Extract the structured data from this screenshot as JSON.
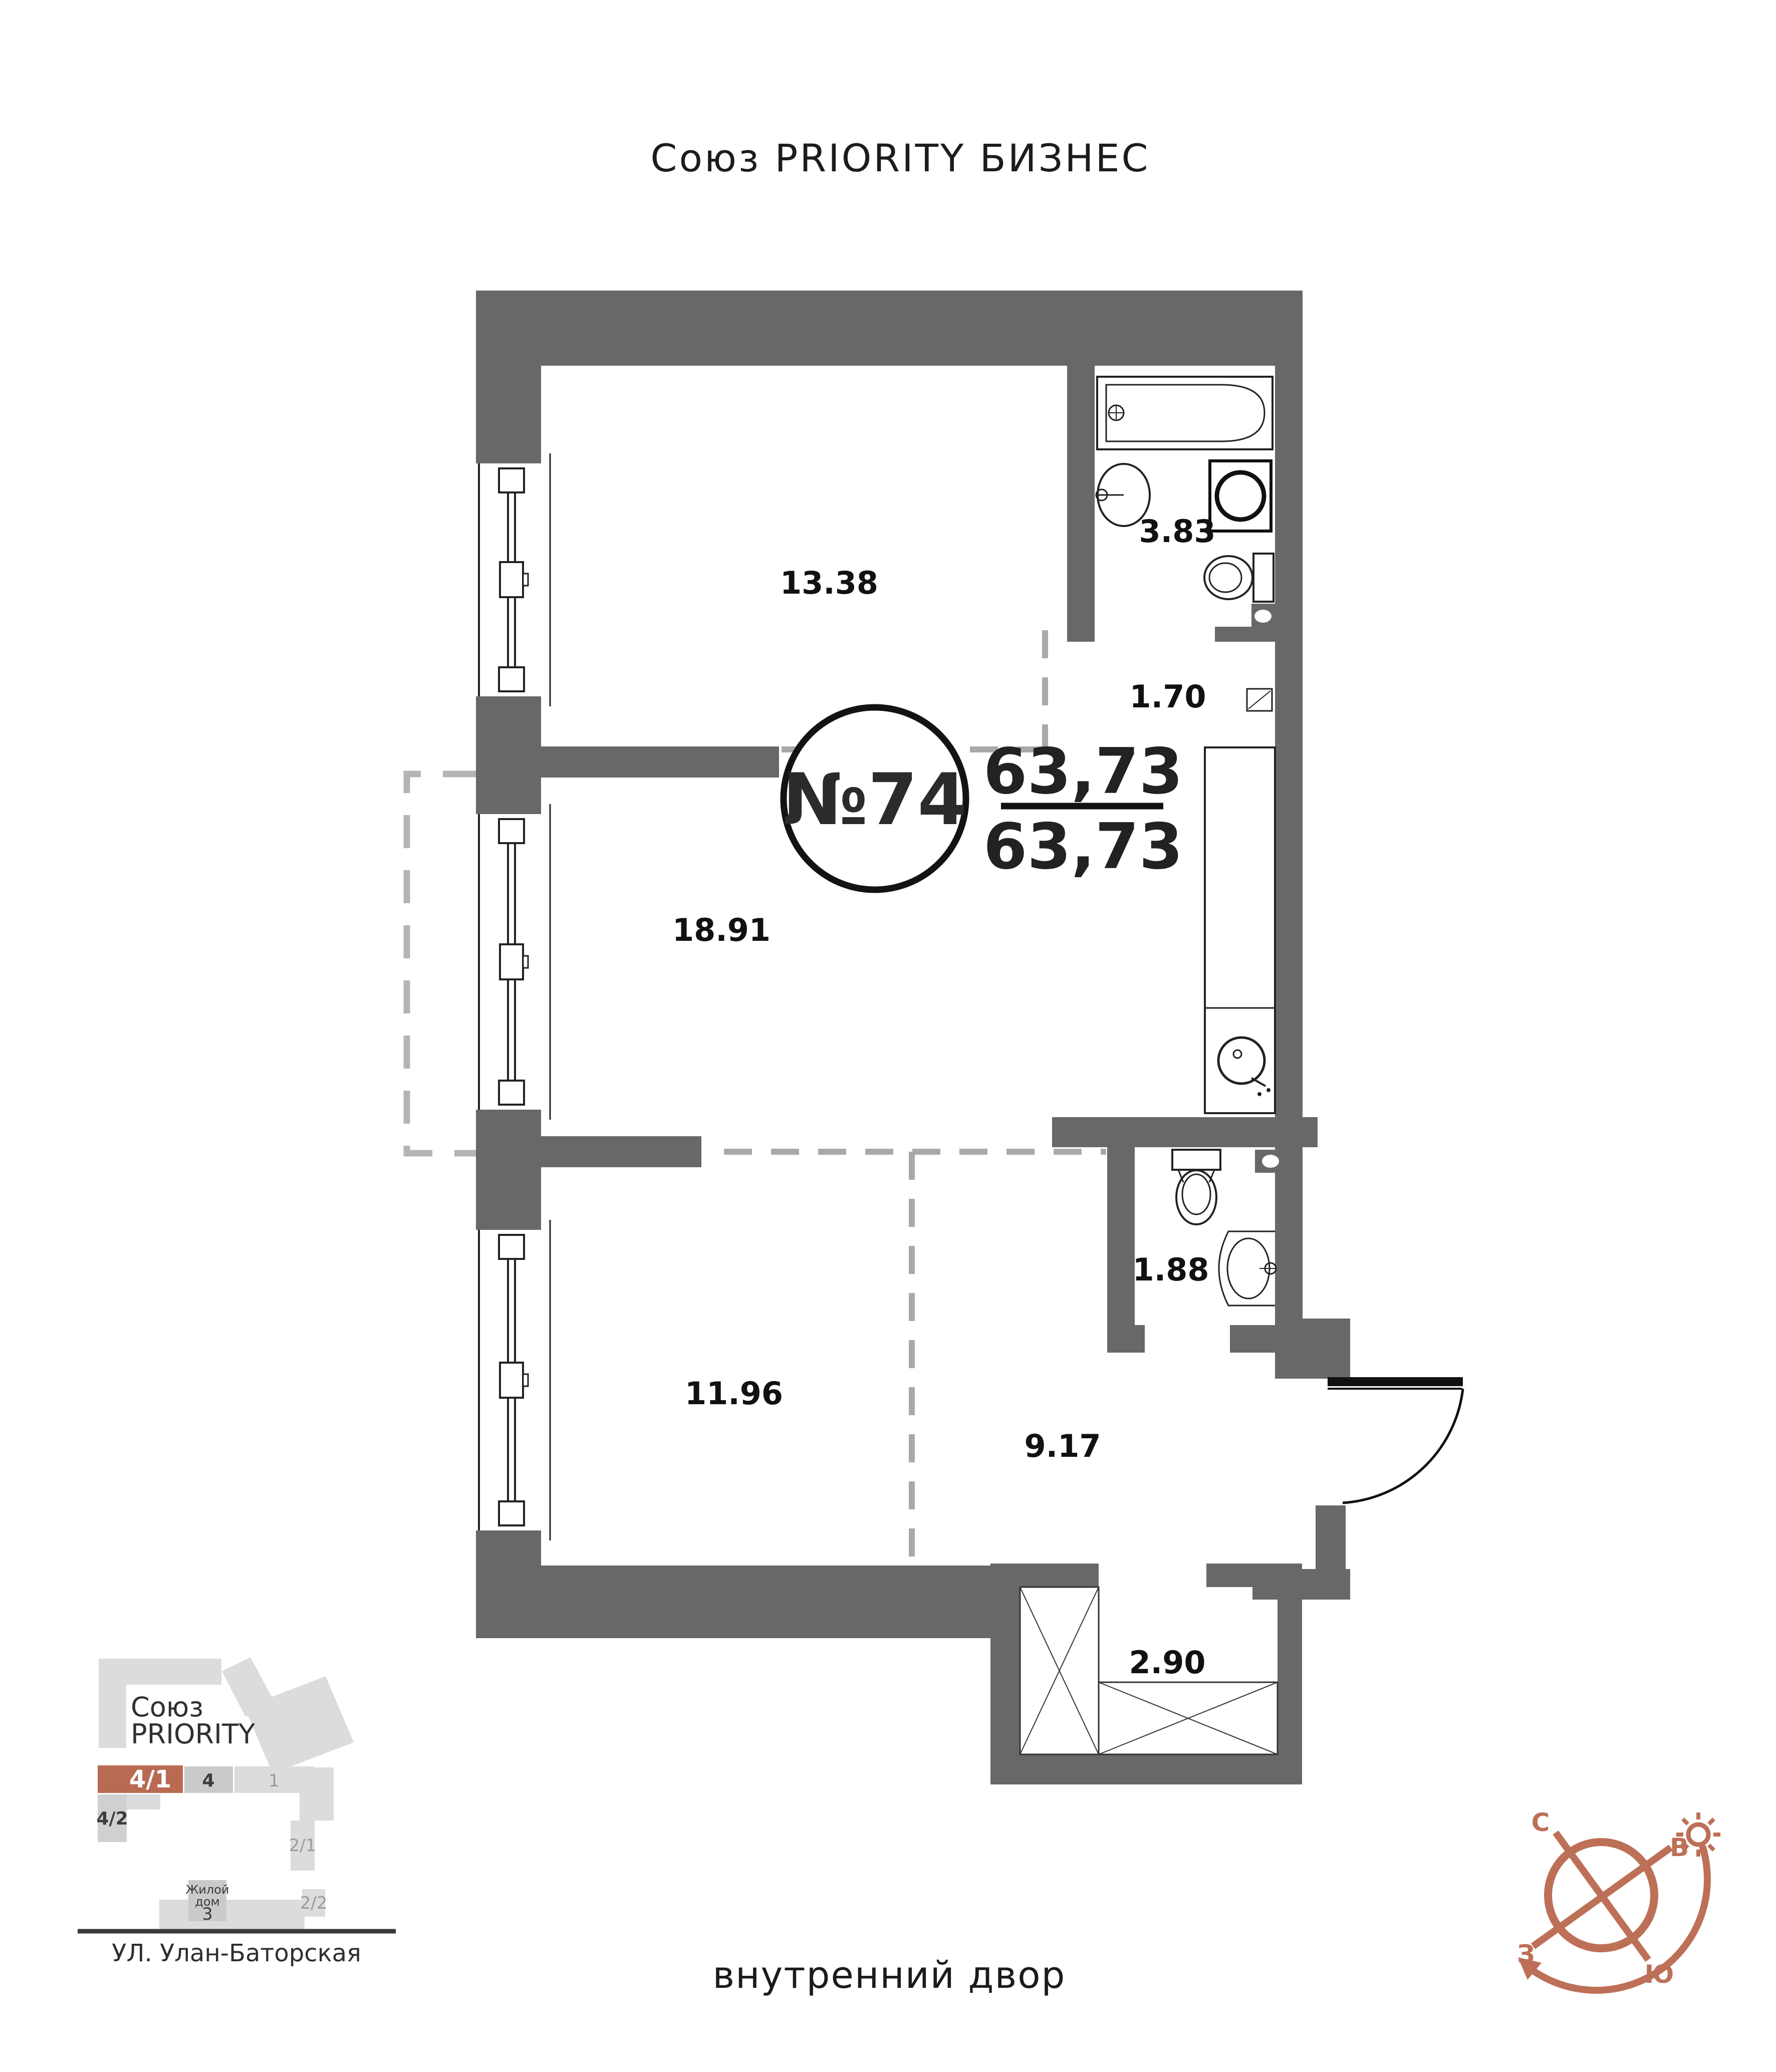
{
  "title": "Союз PRIORITY БИЗНЕС",
  "plan": {
    "apartment_number": "№74",
    "area_numerator": "63,73",
    "area_denominator": "63,73",
    "rooms": [
      {
        "name": "bedroom",
        "area": "13.38"
      },
      {
        "name": "bathroom",
        "area": "3.83"
      },
      {
        "name": "corridor",
        "area": "1.70"
      },
      {
        "name": "living-room",
        "area": "18.91"
      },
      {
        "name": "bedroom-2",
        "area": "11.96"
      },
      {
        "name": "wc",
        "area": "1.88"
      },
      {
        "name": "hallway",
        "area": "9.17"
      },
      {
        "name": "balcony",
        "area": "2.90"
      }
    ]
  },
  "minimap": {
    "project_name_line1": "Союз",
    "project_name_line2": "PRIORITY",
    "street": "УЛ. Улан-Баторская",
    "blocks": [
      {
        "label": "4/1",
        "highlighted": true
      },
      {
        "label": "4",
        "highlighted": false
      },
      {
        "label": "1",
        "highlighted": false
      },
      {
        "label": "4/2",
        "highlighted": false
      },
      {
        "label": "2/1",
        "highlighted": false
      },
      {
        "label": "2/2",
        "highlighted": false
      }
    ],
    "house_block": {
      "line1": "Жилой",
      "line2": "дом",
      "number": "3"
    }
  },
  "compass": {
    "north": "С",
    "east": "В",
    "west": "З",
    "south": "Ю"
  },
  "courtyard_label": "внутренний двор",
  "colors": {
    "wall": "#67686a",
    "dash": "#a9a9a9",
    "accent": "#b96a52",
    "compass": "#bd7057"
  }
}
